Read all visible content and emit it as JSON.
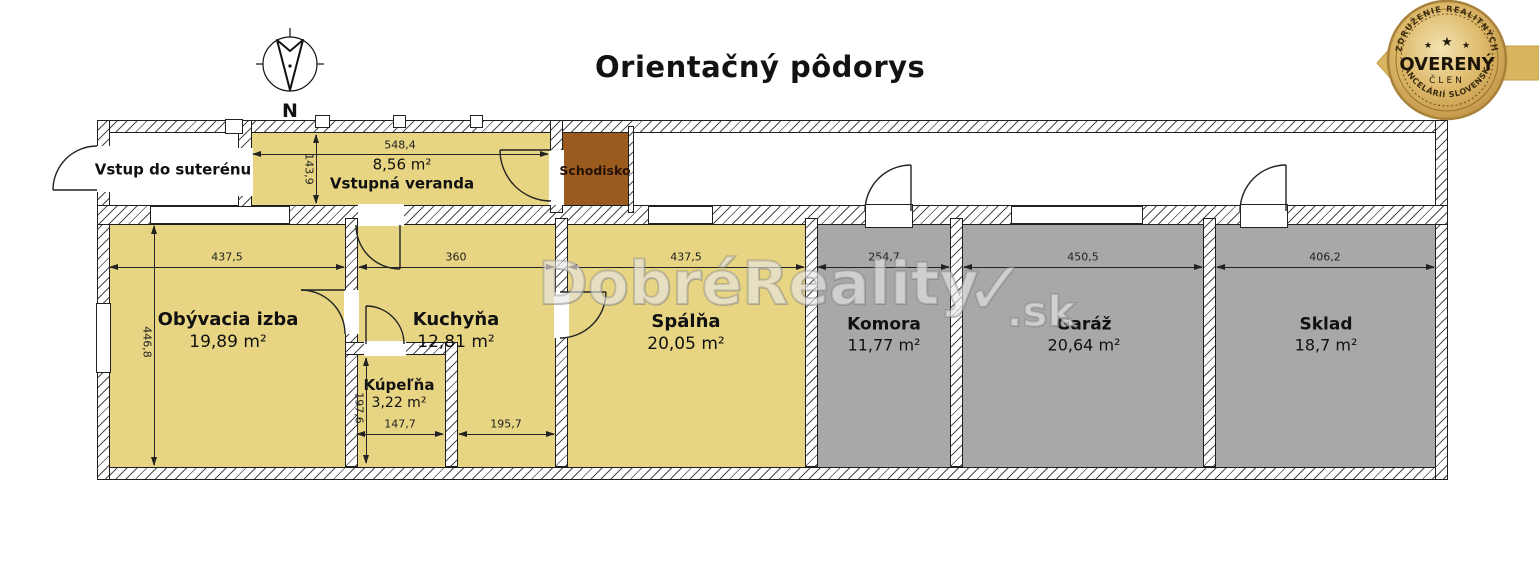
{
  "page": {
    "title": "Orientačný pôdorys"
  },
  "compass": {
    "north_label": "N"
  },
  "badge": {
    "arc_top": "ZDRUŽENIE REALITNÝCH",
    "arc_bottom": "KANCELÁRIÍ SLOVENSKA",
    "title": "OVERENÝ",
    "subtitle": "ČLEN",
    "star": "★"
  },
  "watermark": {
    "brand": "DobréReality",
    "check": "✓",
    "tld": ".sk"
  },
  "rooms": {
    "vstup": {
      "name": "Vstup do suterénu"
    },
    "veranda": {
      "name": "Vstupná veranda",
      "area": "8,56 m²"
    },
    "schodisko": {
      "name": "Schodisko"
    },
    "obyvacia": {
      "name": "Obývacia izba",
      "area": "19,89 m²"
    },
    "kuchyna": {
      "name": "Kuchyňa",
      "area": "12,81 m²"
    },
    "kupelna": {
      "name": "Kúpeľňa",
      "area": "3,22 m²"
    },
    "spalna": {
      "name": "Spálňa",
      "area": "20,05 m²"
    },
    "komora": {
      "name": "Komora",
      "area": "11,77 m²"
    },
    "garaz": {
      "name": "Garáž",
      "area": "20,64 m²"
    },
    "sklad": {
      "name": "Sklad",
      "area": "18,7 m²"
    }
  },
  "dimensions": {
    "veranda_w": "548,4",
    "veranda_h": "143,9",
    "obyvacia_w": "437,5",
    "obyvacia_h": "446,8",
    "kuchyna_w": "360",
    "spalna_w": "437,5",
    "komora_w": "254,7",
    "garaz_w": "450,5",
    "sklad_w": "406,2",
    "kupelna_w": "147,7",
    "kuchyna_lower_w": "195,7",
    "kupelna_h": "197,6"
  },
  "colors": {
    "room-yellow": "#e7d583",
    "room-gray": "#a8a8a8",
    "stair-brown": "#9b5b1e",
    "badge-gold": "#d9b55f",
    "wall-line": "#1f1f1f"
  }
}
